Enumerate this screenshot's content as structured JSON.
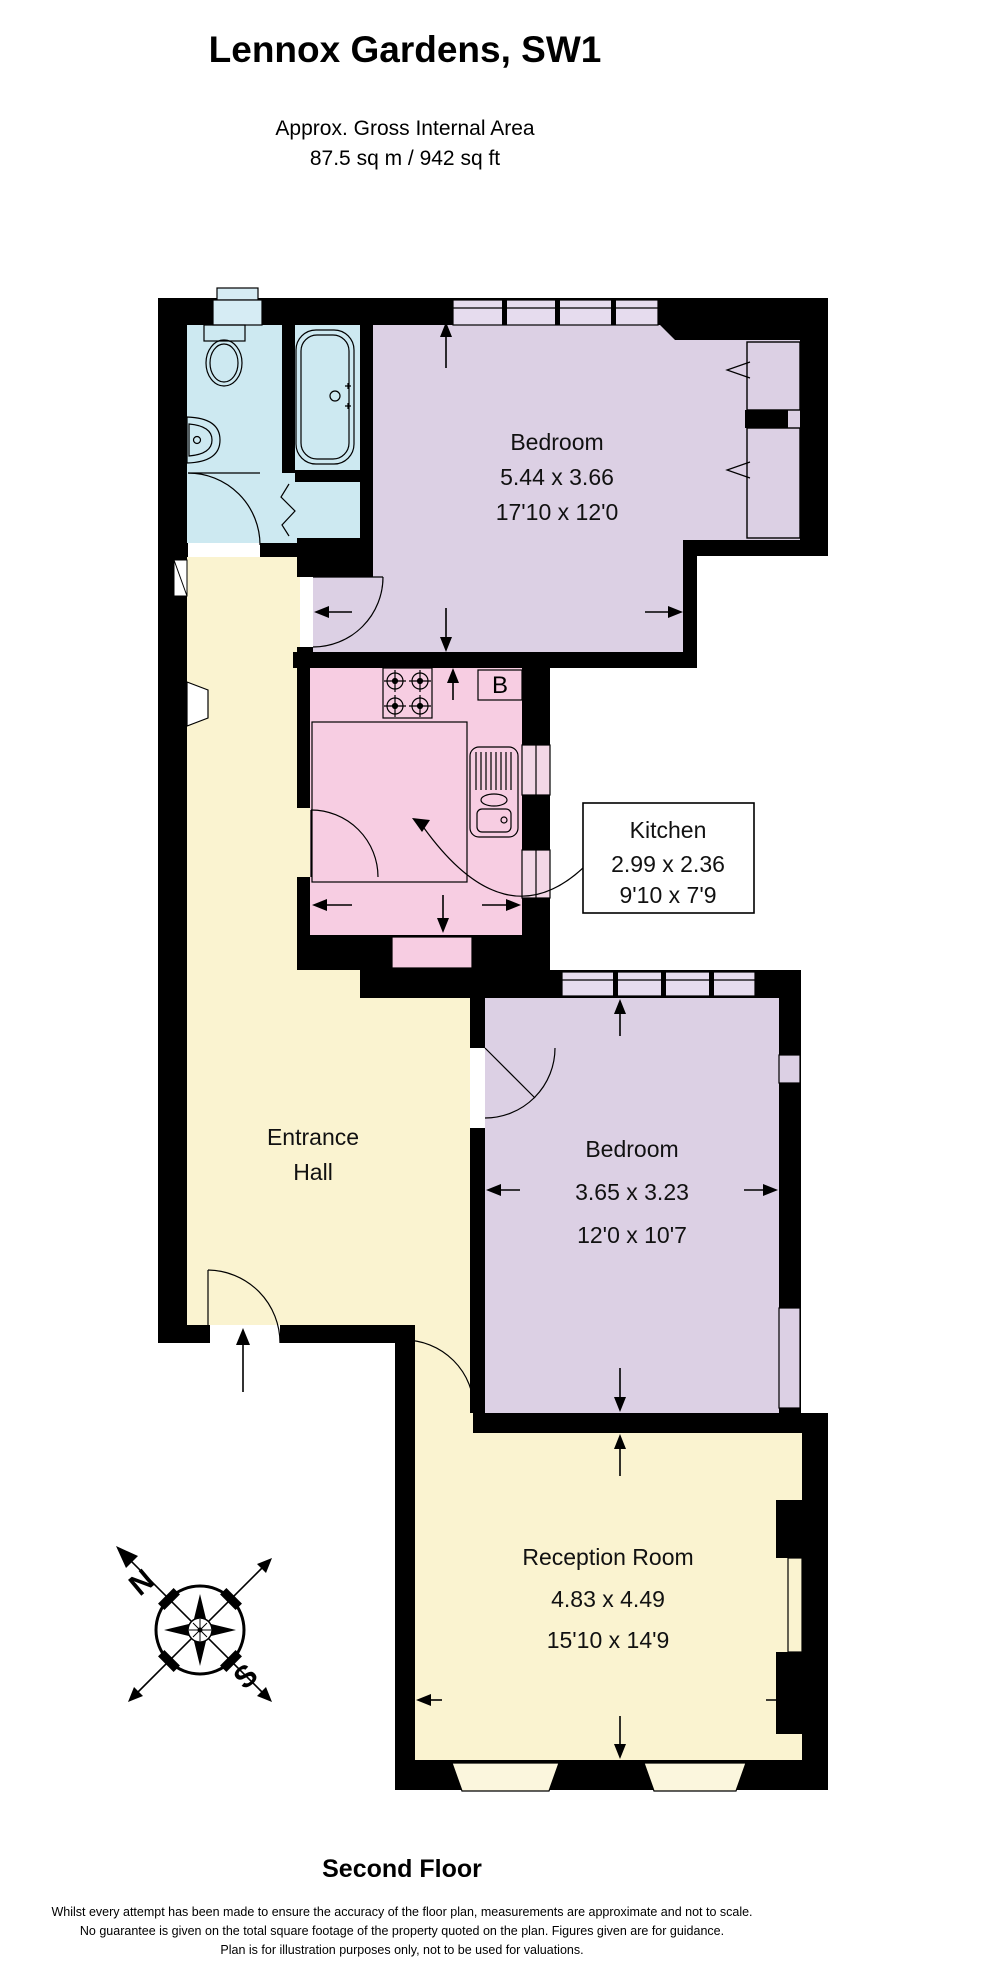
{
  "header": {
    "title": "Lennox Gardens, SW1",
    "subtitle": "Approx. Gross Internal Area",
    "area": "87.5 sq m / 942 sq ft"
  },
  "floor_label": "Second Floor",
  "rooms": [
    {
      "id": "bedroom-1",
      "name": "Bedroom",
      "dim_m": "5.44 x 3.66",
      "dim_ft": "17'10 x 12'0"
    },
    {
      "id": "kitchen",
      "name": "Kitchen",
      "dim_m": "2.99 x 2.36",
      "dim_ft": "9'10 x 7'9"
    },
    {
      "id": "entrance-hall",
      "name": "Entrance Hall",
      "line1": "Entrance",
      "line2": "Hall"
    },
    {
      "id": "bedroom-2",
      "name": "Bedroom",
      "dim_m": "3.65 x 3.23",
      "dim_ft": "12'0 x 10'7"
    },
    {
      "id": "reception-room",
      "name": "Reception Room",
      "dim_m": "4.83 x 4.49",
      "dim_ft": "15'10 x 14'9"
    }
  ],
  "boiler_label": "B",
  "compass": {
    "north_label": "N",
    "south_label": "S"
  },
  "colors": {
    "wall": "#000000",
    "bathroom": "#cde9f1",
    "bedroom": "#dcd0e4",
    "kitchen": "#f7cde2",
    "hall_reception": "#faf3d0",
    "window_bedroom": "#e6dcee",
    "window_kitchen": "#f3d7e6",
    "window_bathroom": "#d6ecf4",
    "window_reception": "#fbf6dd"
  },
  "disclaimer": {
    "line1": "Whilst every attempt has been made to ensure the accuracy of the floor plan, measurements are approximate and not to scale.",
    "line2": "No guarantee is given on the total square footage of the property quoted on the plan. Figures given are for guidance.",
    "line3": "Plan is for illustration purposes only, not to be used for valuations."
  }
}
